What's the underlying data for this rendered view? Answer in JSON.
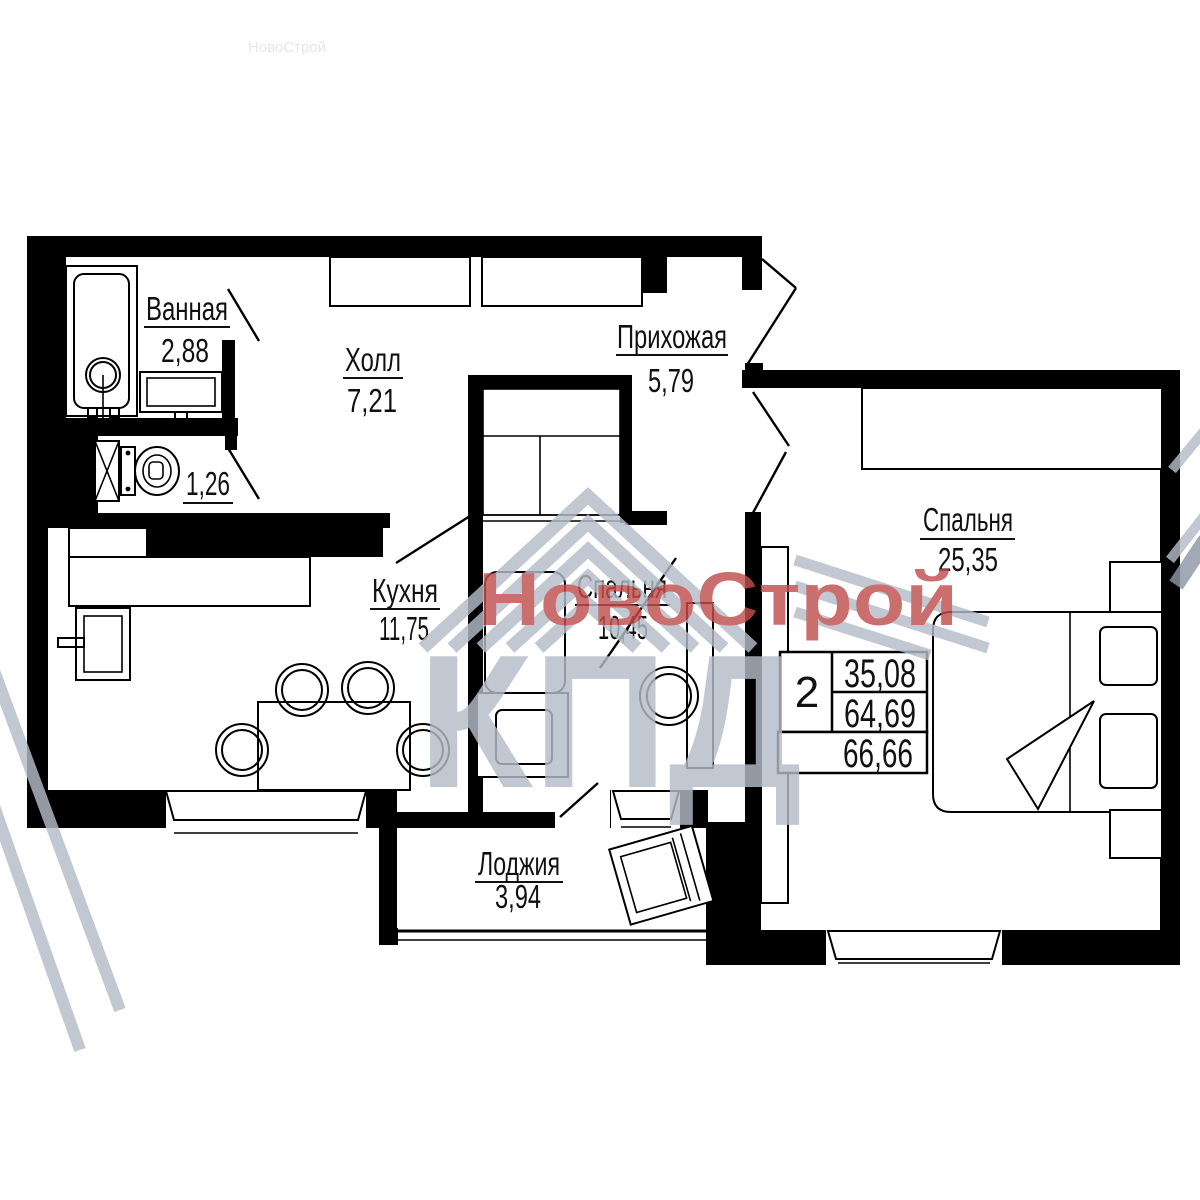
{
  "watermark": {
    "brand_text": "НовоСтрой",
    "logo_text": "КПД",
    "brand_color": "#c0504f",
    "logo_color": "#b4bcc8",
    "accent_color": "#8d97a8"
  },
  "rooms": {
    "bathroom": {
      "name": "Ванная",
      "area": "2,88"
    },
    "toilet": {
      "area": "1,26"
    },
    "hall": {
      "name": "Холл",
      "area": "7,21"
    },
    "entry": {
      "name": "Прихожая",
      "area": "5,79"
    },
    "kitchen": {
      "name": "Кухня",
      "area": "11,75"
    },
    "bedroom_small": {
      "name": "Спальня",
      "area": "10,45"
    },
    "bedroom_large": {
      "name": "Спальня",
      "area": "25,35"
    },
    "loggia": {
      "name": "Лоджия",
      "area": "3,94"
    }
  },
  "info_table": {
    "rooms_count": "2",
    "living_area": "35,08",
    "apartment_area": "64,69",
    "total_area": "66,66"
  }
}
